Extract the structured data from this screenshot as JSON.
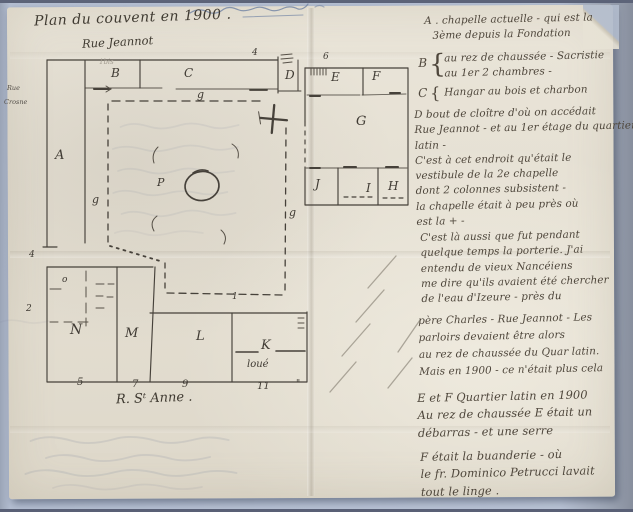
{
  "title": "Plan du couvent en 1900 .",
  "plan": {
    "streets": {
      "top": "Rue Jeannot",
      "left1": "Rue",
      "left2": "Crosne",
      "bottom": "R. Sᵗ Anne ."
    },
    "rooms": {
      "a": "A",
      "b": "B",
      "c": "C",
      "d": "D",
      "e": "E",
      "f": "F",
      "g_room": "G",
      "h": "H",
      "i": "I",
      "j": "J",
      "k": "K",
      "l": "L",
      "m": "M",
      "n": "N",
      "p": "P",
      "o": "o"
    },
    "gallery": {
      "top": "g",
      "left": "g",
      "right": "g"
    },
    "numbers": {
      "jeannot_4": "4",
      "jeannot_6": "6",
      "one_bis": "1bis",
      "left_top": "4",
      "left_bottom": "2",
      "gallery_1": "1",
      "st_anne": [
        "5",
        "7",
        "9",
        "11"
      ],
      "ditto": "\""
    },
    "annotations": {
      "loue": "loué"
    }
  },
  "notes": {
    "paragraphs": [
      {
        "lines": [
          "A . chapelle actuelle - qui est la",
          "3ème depuis la Fondation"
        ]
      },
      {
        "letter": "B",
        "brace": "{",
        "lines": [
          "au rez de chaussée - Sacristie",
          "au 1er 2 chambres -"
        ]
      },
      {
        "letter": "C",
        "brace": "{",
        "lines": [
          "Hangar au bois et charbon"
        ]
      },
      {
        "lines": [
          "D bout de cloître d'où on accédait",
          "Rue Jeannot - et au 1er étage du quartier",
          "latin -",
          "C'est à cet endroit qu'était le",
          "vestibule de la 2e chapelle",
          "dont 2 colonnes subsistent -",
          "la chapelle était à peu près où",
          "est la + -"
        ]
      },
      {
        "lines": [
          "C'est là aussi que fut pendant",
          "quelque temps la porterie. J'ai",
          "entendu de vieux Nancéiens",
          "me dire qu'ils avaient été chercher",
          "de l'eau d'Izeure - près du"
        ]
      },
      {
        "lines": [
          "père Charles - Rue Jeannot - Les",
          "parloirs devaient être alors",
          "au rez de chaussée du Quar latin.",
          "Mais en 1900 - ce n'était plus cela"
        ]
      },
      {
        "lines": [
          "E et F Quartier latin en 1900",
          "Au rez de chaussée E était un",
          "débarras - et une serre"
        ]
      },
      {
        "lines": [
          "F était la buanderie - où",
          "le fr. Dominico Petrucci lavait",
          "tout le linge ."
        ]
      }
    ]
  }
}
